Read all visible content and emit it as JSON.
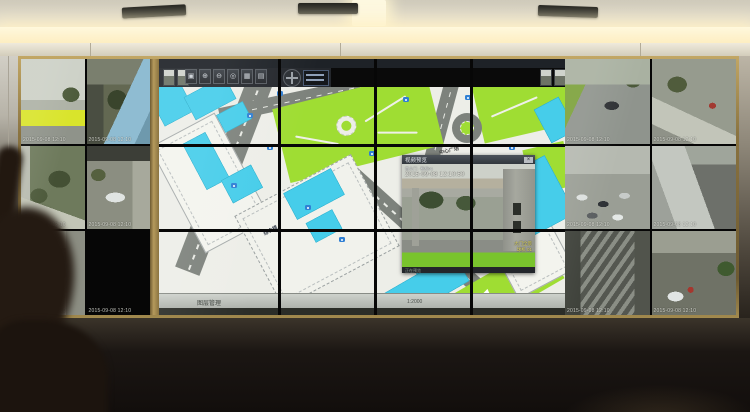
{
  "wall": {
    "left_feeds": [
      {
        "osd": "2015-09-08 12:10"
      },
      {
        "osd": "2015-09-08 12:10"
      },
      {
        "osd": "2015-09-08 12:10"
      },
      {
        "osd": "2015-09-08 12:10"
      },
      {
        "osd": "2015-09-08 12:10"
      },
      {
        "osd": "2015-09-08 12:10"
      }
    ],
    "right_feeds": [
      {
        "osd": "2015-09-08 12:10"
      },
      {
        "osd": "2015-09-08 12:10"
      },
      {
        "osd": "2015-09-08 12:10"
      },
      {
        "osd": "2015-09-08 12:10"
      },
      {
        "osd": "2015-09-08 12:10"
      },
      {
        "osd": "2015-09-08 12:10"
      }
    ]
  },
  "map": {
    "toolbar_buttons": [
      {
        "glyph": "▣"
      },
      {
        "glyph": "⊕"
      },
      {
        "glyph": "⊖"
      },
      {
        "glyph": "◎"
      },
      {
        "glyph": "▦"
      },
      {
        "glyph": "▤"
      }
    ],
    "status_left": "图层管理",
    "scale_text": "1:2000",
    "labels": [
      {
        "text": "培训中心大楼"
      },
      {
        "text": "中心广场"
      },
      {
        "text": "综合楼"
      }
    ],
    "popup": {
      "title": "视频预览",
      "camera_line": "南大门 · 枪机01",
      "timestamp": "2015-09-08 12:10:50",
      "osd_lines": [
        "大门全景",
        "球机 01"
      ],
      "status_text": "正在预览",
      "close_label": "×"
    }
  }
}
